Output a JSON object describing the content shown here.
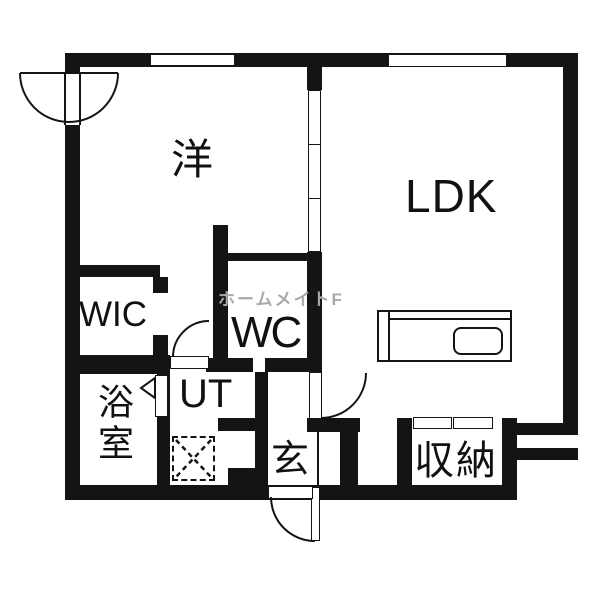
{
  "floorplan": {
    "type": "japanese-apartment-floorplan-1LDK",
    "rooms": {
      "western_room": "洋",
      "ldk": "LDK",
      "walk_in_closet": "WIC",
      "toilet": "WC",
      "utility": "UT",
      "bathroom": "浴室",
      "entrance": "玄",
      "storage": "収納"
    },
    "watermark": "ホームメイトF",
    "colors": {
      "wall": "#141414",
      "bg": "#ffffff",
      "watermark": "#a9a9a9"
    }
  }
}
